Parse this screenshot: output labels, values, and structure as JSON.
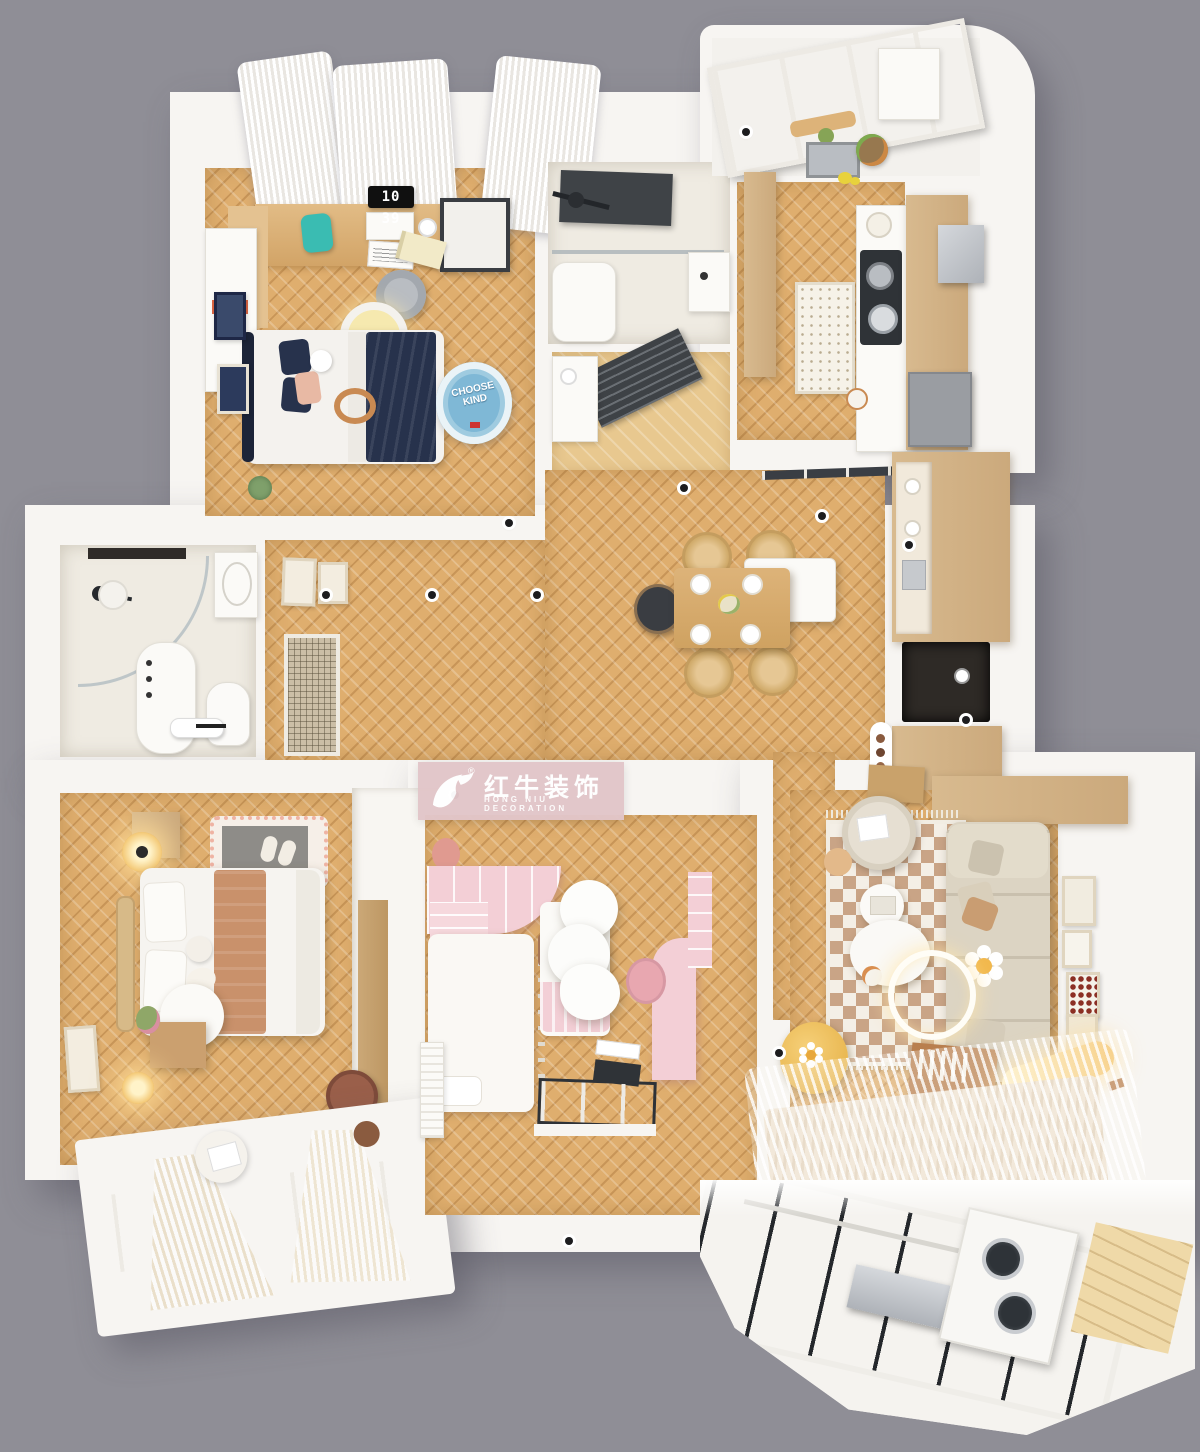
{
  "watermark": {
    "brand": "红牛装饰",
    "subtitle": "HONG NIU DECORATION",
    "registered": "®"
  },
  "bedroom_clock": {
    "time": "10 39"
  },
  "round_rug": {
    "text": "CHOOSE KIND"
  },
  "colors": {
    "bg": "#8F8E96",
    "wall": "#F7F5F2",
    "wall-bright": "#FFFFFF",
    "wall-shade": "#E9E6E0",
    "floor": "#DFAE6E",
    "floor-dark": "#C08A4A",
    "floor-pale": "#EED9AE",
    "bath-floor": "#EFEBE2",
    "pink-banner": "#E2C6C9",
    "pink": "#F3CFD6",
    "pink-deep": "#E8A7B0",
    "navy": "#27324C",
    "navy-deep": "#1C2438",
    "tan": "#C9916B",
    "sofa": "#DCD4C3",
    "checker": "#C9A486",
    "cream": "#F4EFE6",
    "wood": "#D8BA8F",
    "wood-deep": "#B97F4E",
    "dark": "#33363A",
    "glass": "#565B63",
    "steel": "#C3C6CB",
    "glow": "#FFE3A0",
    "teal": "#3ABCB2",
    "rugblue": "#7FB8D6",
    "yellow": "#F0C25C",
    "blush": "#E8B9A4",
    "grayitem": "#8E8C88"
  }
}
